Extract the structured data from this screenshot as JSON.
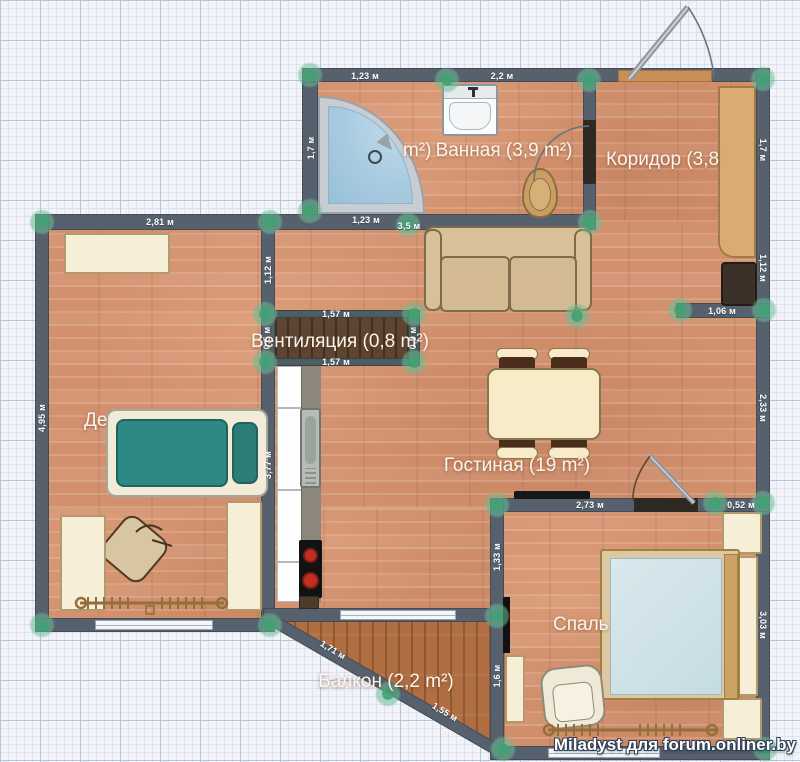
{
  "app": {
    "watermark": "Miladyst для forum.onliner.by"
  },
  "colors": {
    "wall": "#57616d",
    "node_green": "#42a474",
    "floor_wood": "#d2906e",
    "floor_balcony": "#b06f42",
    "kids_bed_teal": "#2e8984",
    "bedroom_bed_blue": "#cfe3e9",
    "shower_blue": "#a9cbe0",
    "stove_burner_red": "#c03022",
    "furniture_cream": "#f6eed6"
  },
  "rooms": [
    {
      "id": "bathroom",
      "label": "Ванная (3,9 m²)",
      "x": 504,
      "y": 151,
      "anchor": "center"
    },
    {
      "id": "bathroom-partial",
      "label": "m²)",
      "x": 403,
      "y": 151,
      "anchor": "left"
    },
    {
      "id": "corridor",
      "label": "Коридор (3,8",
      "x": 606,
      "y": 160,
      "anchor": "left"
    },
    {
      "id": "ventilation",
      "label": "Вентиляция (0,8 m²)",
      "x": 340,
      "y": 342,
      "anchor": "center"
    },
    {
      "id": "children",
      "label": "Де",
      "x": 84,
      "y": 421,
      "anchor": "left"
    },
    {
      "id": "living",
      "label": "Гостиная (19 m²)",
      "x": 517,
      "y": 466,
      "anchor": "center"
    },
    {
      "id": "bedroom",
      "label": "Спаль",
      "x": 553,
      "y": 625,
      "anchor": "left"
    },
    {
      "id": "balcony",
      "label": "Балкон (2,2 m²)",
      "x": 386,
      "y": 682,
      "anchor": "center"
    }
  ],
  "measurements": [
    {
      "text": "1,23 м",
      "x": 365,
      "y": 76,
      "rot": 0
    },
    {
      "text": "2,2 м",
      "x": 502,
      "y": 76,
      "rot": 0
    },
    {
      "text": "1,7 м",
      "x": 311,
      "y": 148,
      "rot": -90
    },
    {
      "text": "1,7 м",
      "x": 763,
      "y": 150,
      "rot": 90
    },
    {
      "text": "1,23 м",
      "x": 366,
      "y": 220,
      "rot": 0
    },
    {
      "text": "3,5 м",
      "x": 409,
      "y": 226,
      "rot": 0
    },
    {
      "text": "2,81 м",
      "x": 160,
      "y": 222,
      "rot": 0
    },
    {
      "text": "1,12 м",
      "x": 268,
      "y": 270,
      "rot": -90
    },
    {
      "text": "1,12 м",
      "x": 763,
      "y": 268,
      "rot": 90
    },
    {
      "text": "1,06 м",
      "x": 722,
      "y": 311,
      "rot": 0
    },
    {
      "text": "2,33 м",
      "x": 763,
      "y": 408,
      "rot": 90
    },
    {
      "text": "4,95 м",
      "x": 42,
      "y": 418,
      "rot": -90
    },
    {
      "text": "3,77 м",
      "x": 268,
      "y": 465,
      "rot": -90
    },
    {
      "text": "1,57 м",
      "x": 336,
      "y": 314,
      "rot": 0
    },
    {
      "text": "1,57 м",
      "x": 336,
      "y": 362,
      "rot": 0
    },
    {
      "text": "0,5 м",
      "x": 267,
      "y": 338,
      "rot": -90
    },
    {
      "text": "0,5 м",
      "x": 413,
      "y": 338,
      "rot": -90
    },
    {
      "text": "2,73 м",
      "x": 590,
      "y": 505,
      "rot": 0
    },
    {
      "text": "0,52 м",
      "x": 741,
      "y": 505,
      "rot": 0
    },
    {
      "text": "1,33 м",
      "x": 497,
      "y": 557,
      "rot": -90
    },
    {
      "text": "1,6 м",
      "x": 497,
      "y": 676,
      "rot": -90
    },
    {
      "text": "3,03 м",
      "x": 763,
      "y": 625,
      "rot": 90
    },
    {
      "text": "1,71 м",
      "x": 333,
      "y": 650,
      "rot": 31
    },
    {
      "text": "1,55 м",
      "x": 445,
      "y": 712,
      "rot": 31
    }
  ]
}
